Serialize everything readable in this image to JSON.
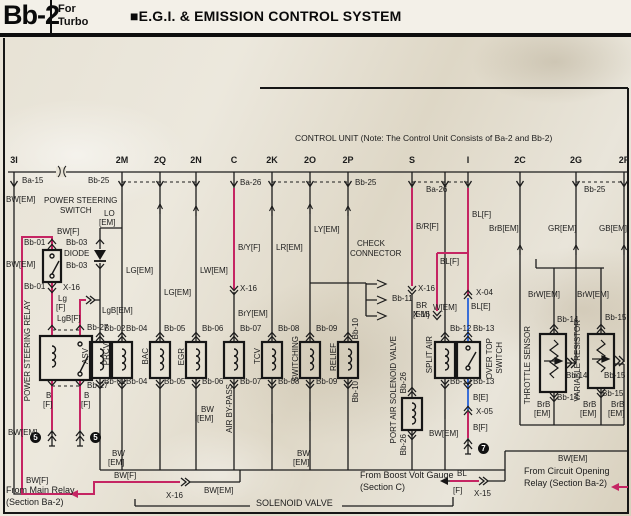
{
  "header": {
    "page_code": "Bb-2",
    "variant_line1": "For",
    "variant_line2": "Turbo",
    "title": "■E.G.I. & EMISSION CONTROL SYSTEM"
  },
  "control_unit_note": "CONTROL UNIT (Note: The Control Unit Consists of Ba-2 and Bb-2)",
  "accent_colors": {
    "highlight_wire": "#c52563",
    "blue_wire": "#3a6fd8",
    "ink": "#1a1a1a"
  },
  "diagram": {
    "labels": [
      {
        "n": "pin-3i",
        "t": "3I",
        "x": 14,
        "y": 156,
        "k": "pin"
      },
      {
        "n": "pin-2m",
        "t": "2M",
        "x": 122,
        "y": 156,
        "k": "pin"
      },
      {
        "n": "pin-2q",
        "t": "2Q",
        "x": 160,
        "y": 156,
        "k": "pin"
      },
      {
        "n": "pin-2n",
        "t": "2N",
        "x": 196,
        "y": 156,
        "k": "pin"
      },
      {
        "n": "pin-c",
        "t": "C",
        "x": 234,
        "y": 156,
        "k": "pin"
      },
      {
        "n": "pin-2k",
        "t": "2K",
        "x": 272,
        "y": 156,
        "k": "pin"
      },
      {
        "n": "pin-2o",
        "t": "2O",
        "x": 310,
        "y": 156,
        "k": "pin"
      },
      {
        "n": "pin-2p",
        "t": "2P",
        "x": 348,
        "y": 156,
        "k": "pin"
      },
      {
        "n": "pin-s",
        "t": "S",
        "x": 412,
        "y": 156,
        "k": "pin"
      },
      {
        "n": "pin-i",
        "t": "I",
        "x": 468,
        "y": 156,
        "k": "pin"
      },
      {
        "n": "pin-2c",
        "t": "2C",
        "x": 520,
        "y": 156,
        "k": "pin"
      },
      {
        "n": "pin-2g",
        "t": "2G",
        "x": 576,
        "y": 156,
        "k": "pin"
      },
      {
        "n": "pin-2f",
        "t": "2F",
        "x": 624,
        "y": 156,
        "k": "pin"
      },
      {
        "n": "conn-ba15",
        "t": "Ba-15",
        "x": 22,
        "y": 177,
        "k": "ref"
      },
      {
        "n": "conn-bb25-a",
        "t": "Bb-25",
        "x": 88,
        "y": 177,
        "k": "ref"
      },
      {
        "n": "conn-ba26-a",
        "t": "Ba-26",
        "x": 240,
        "y": 179,
        "k": "ref"
      },
      {
        "n": "conn-bb25-b",
        "t": "Bb-25",
        "x": 355,
        "y": 179,
        "k": "ref"
      },
      {
        "n": "conn-ba26-b",
        "t": "Ba-26",
        "x": 426,
        "y": 186,
        "k": "ref"
      },
      {
        "n": "conn-bb25-c",
        "t": "Bb-25",
        "x": 584,
        "y": 186,
        "k": "ref"
      },
      {
        "n": "wire-bw-em-top",
        "t": "BW[EM]",
        "x": 6,
        "y": 196,
        "k": "wire"
      },
      {
        "n": "label-power-steering",
        "t": "POWER STEERING",
        "x": 44,
        "y": 197,
        "k": "name"
      },
      {
        "n": "label-switch",
        "t": "SWITCH",
        "x": 60,
        "y": 207,
        "k": "name"
      },
      {
        "n": "wire-bw-f-top",
        "t": "BW[F]",
        "x": 57,
        "y": 228,
        "k": "wire"
      },
      {
        "n": "conn-bb01-top",
        "t": "Bb-01",
        "x": 24,
        "y": 239,
        "k": "ref"
      },
      {
        "n": "conn-bb01-bot",
        "t": "Bb-01",
        "x": 24,
        "y": 283,
        "k": "ref"
      },
      {
        "n": "wire-bw-em-switch",
        "t": "BW[EM]",
        "x": 6,
        "y": 261,
        "k": "wire"
      },
      {
        "n": "conn-x16-switch",
        "t": "X-16",
        "x": 63,
        "y": 284,
        "k": "ref"
      },
      {
        "n": "wire-lg-f-1",
        "t": "Lg",
        "x": 58,
        "y": 295,
        "k": "wire"
      },
      {
        "n": "wire-lg-f-2",
        "t": "[F]",
        "x": 56,
        "y": 304,
        "k": "wire"
      },
      {
        "n": "wire-lgb-f",
        "t": "LgB[F]",
        "x": 57,
        "y": 315,
        "k": "wire"
      },
      {
        "n": "conn-bb03-top",
        "t": "Bb-03",
        "x": 66,
        "y": 239,
        "k": "ref"
      },
      {
        "n": "label-diode",
        "t": "DIODE",
        "x": 64,
        "y": 250,
        "k": "name"
      },
      {
        "n": "conn-bb03-bot",
        "t": "Bb-03",
        "x": 66,
        "y": 262,
        "k": "ref"
      },
      {
        "n": "wire-lo-1",
        "t": "LO",
        "x": 104,
        "y": 210,
        "k": "wire"
      },
      {
        "n": "wire-lo-2",
        "t": "[EM]",
        "x": 99,
        "y": 219,
        "k": "wire"
      },
      {
        "n": "wire-lgb-em",
        "t": "LgB[EM]",
        "x": 102,
        "y": 307,
        "k": "wire"
      },
      {
        "n": "name-ps-relay",
        "t": "POWER STEERING RELAY",
        "x": 24,
        "y": 300,
        "k": "vname"
      },
      {
        "n": "conn-bb27-top",
        "t": "Bb-27",
        "x": 87,
        "y": 324,
        "k": "ref"
      },
      {
        "n": "conn-bb27-bot",
        "t": "Bb-27",
        "x": 87,
        "y": 382,
        "k": "ref"
      },
      {
        "n": "wire-b-f-l1",
        "t": "B",
        "x": 46,
        "y": 392,
        "k": "wire"
      },
      {
        "n": "wire-b-f-l2",
        "t": "[F]",
        "x": 43,
        "y": 401,
        "k": "wire"
      },
      {
        "n": "wire-b-f-r1",
        "t": "B",
        "x": 84,
        "y": 392,
        "k": "wire"
      },
      {
        "n": "wire-b-f-r2",
        "t": "[F]",
        "x": 81,
        "y": 401,
        "k": "wire"
      },
      {
        "n": "badge-ground-5a",
        "t": "5",
        "x": 30,
        "y": 432,
        "k": "badge"
      },
      {
        "n": "badge-ground-5b",
        "t": "5",
        "x": 90,
        "y": 432,
        "k": "badge"
      },
      {
        "n": "wire-bw-em-left-bot",
        "t": "BW[EM]",
        "x": 8,
        "y": 429,
        "k": "wire"
      },
      {
        "n": "conn-bb02-top",
        "t": "Bb-02",
        "x": 104,
        "y": 325,
        "k": "ref"
      },
      {
        "n": "conn-bb02-bot",
        "t": "Bb-02",
        "x": 104,
        "y": 378,
        "k": "ref"
      },
      {
        "n": "name-asv",
        "t": "ASV",
        "x": 82,
        "y": 348,
        "k": "vname"
      },
      {
        "n": "wire-lg-em-2m",
        "t": "LG[EM]",
        "x": 126,
        "y": 267,
        "k": "wire"
      },
      {
        "n": "conn-bb04-top",
        "t": "Bb-04",
        "x": 126,
        "y": 325,
        "k": "ref"
      },
      {
        "n": "conn-bb04-bot",
        "t": "Bb-04",
        "x": 126,
        "y": 378,
        "k": "ref"
      },
      {
        "n": "name-prcv",
        "t": "PRCV",
        "x": 103,
        "y": 343,
        "k": "vname"
      },
      {
        "n": "wire-lg-em-2q",
        "t": "LG[EM]",
        "x": 164,
        "y": 289,
        "k": "wire"
      },
      {
        "n": "conn-bb05-top",
        "t": "Bb-05",
        "x": 164,
        "y": 325,
        "k": "ref"
      },
      {
        "n": "conn-bb05-bot",
        "t": "Bb-05",
        "x": 164,
        "y": 378,
        "k": "ref"
      },
      {
        "n": "name-bac",
        "t": "BAC",
        "x": 142,
        "y": 348,
        "k": "vname"
      },
      {
        "n": "wire-lw-em",
        "t": "LW[EM]",
        "x": 200,
        "y": 267,
        "k": "wire"
      },
      {
        "n": "conn-bb06-top",
        "t": "Bb-06",
        "x": 202,
        "y": 325,
        "k": "ref"
      },
      {
        "n": "conn-bb06-bot",
        "t": "Bb-06",
        "x": 202,
        "y": 378,
        "k": "ref"
      },
      {
        "n": "name-egr",
        "t": "EGR",
        "x": 178,
        "y": 348,
        "k": "vname"
      },
      {
        "n": "wire-by-f",
        "t": "B/Y[F]",
        "x": 238,
        "y": 244,
        "k": "wire"
      },
      {
        "n": "conn-x16-c",
        "t": "X-16",
        "x": 240,
        "y": 285,
        "k": "ref"
      },
      {
        "n": "wire-bry-em",
        "t": "BrY[EM]",
        "x": 238,
        "y": 310,
        "k": "wire"
      },
      {
        "n": "conn-bb07-top",
        "t": "Bb-07",
        "x": 240,
        "y": 325,
        "k": "ref"
      },
      {
        "n": "conn-bb07-bot",
        "t": "Bb-07",
        "x": 240,
        "y": 378,
        "k": "ref"
      },
      {
        "n": "name-air-by-pass",
        "t": "AIR BY-PASS",
        "x": 226,
        "y": 384,
        "k": "vname"
      },
      {
        "n": "wire-lr-em",
        "t": "LR[EM]",
        "x": 276,
        "y": 244,
        "k": "wire"
      },
      {
        "n": "conn-bb08-top",
        "t": "Bb-08",
        "x": 278,
        "y": 325,
        "k": "ref"
      },
      {
        "n": "conn-bb08-bot",
        "t": "Bb-08",
        "x": 278,
        "y": 378,
        "k": "ref"
      },
      {
        "n": "name-tcv",
        "t": "TCV",
        "x": 254,
        "y": 348,
        "k": "vname"
      },
      {
        "n": "wire-ly-em",
        "t": "LY[EM]",
        "x": 314,
        "y": 226,
        "k": "wire"
      },
      {
        "n": "conn-bb09-top",
        "t": "Bb-09",
        "x": 316,
        "y": 325,
        "k": "ref"
      },
      {
        "n": "conn-bb09-bot",
        "t": "Bb-09",
        "x": 316,
        "y": 378,
        "k": "ref"
      },
      {
        "n": "name-switching",
        "t": "SWITCHING",
        "x": 292,
        "y": 336,
        "k": "vname"
      },
      {
        "n": "label-check",
        "t": "CHECK",
        "x": 357,
        "y": 240,
        "k": "name"
      },
      {
        "n": "label-connector",
        "t": "CONNECTOR",
        "x": 350,
        "y": 250,
        "k": "name"
      },
      {
        "n": "conn-bb11",
        "t": "Bb-11",
        "x": 392,
        "y": 295,
        "k": "ref"
      },
      {
        "n": "conn-bb10-top",
        "t": "Bb-10",
        "x": 352,
        "y": 318,
        "k": "vref"
      },
      {
        "n": "conn-bb10-bot",
        "t": "Bb-10",
        "x": 352,
        "y": 381,
        "k": "vref"
      },
      {
        "n": "name-relief",
        "t": "RELIEF",
        "x": 330,
        "y": 343,
        "k": "vname"
      },
      {
        "n": "wire-br-f",
        "t": "B/R[F]",
        "x": 416,
        "y": 223,
        "k": "wire"
      },
      {
        "n": "conn-x16-s",
        "t": "X-16",
        "x": 418,
        "y": 285,
        "k": "ref"
      },
      {
        "n": "wire-br-em-1",
        "t": "BR",
        "x": 416,
        "y": 302,
        "k": "wire"
      },
      {
        "n": "wire-br-em-2",
        "t": "[EM]",
        "x": 413,
        "y": 311,
        "k": "wire"
      },
      {
        "n": "name-port-air",
        "t": "PORT AIR SOLENOID VALVE",
        "x": 390,
        "y": 336,
        "k": "vname"
      },
      {
        "n": "conn-bb26-top",
        "t": "Bb-26",
        "x": 400,
        "y": 372,
        "k": "vref"
      },
      {
        "n": "conn-bb26-bot",
        "t": "Bb-26",
        "x": 400,
        "y": 434,
        "k": "vref"
      },
      {
        "n": "wire-w-em",
        "t": "W[EM]",
        "x": 433,
        "y": 304,
        "k": "wire"
      },
      {
        "n": "conn-bb12-top",
        "t": "Bb-12",
        "x": 450,
        "y": 325,
        "k": "ref"
      },
      {
        "n": "conn-bb12-bot",
        "t": "Bb-12",
        "x": 450,
        "y": 378,
        "k": "ref"
      },
      {
        "n": "name-split-air",
        "t": "SPLIT AIR",
        "x": 426,
        "y": 336,
        "k": "vname"
      },
      {
        "n": "wire-bw-em-split",
        "t": "BW[EM]",
        "x": 429,
        "y": 430,
        "k": "wire"
      },
      {
        "n": "wire-bl-f-main",
        "t": "BL[F]",
        "x": 472,
        "y": 211,
        "k": "wire"
      },
      {
        "n": "wire-bl-f-branch",
        "t": "BL[F]",
        "x": 440,
        "y": 258,
        "k": "wire"
      },
      {
        "n": "conn-x16-branch",
        "t": "X-16",
        "x": 413,
        "y": 311,
        "k": "ref"
      },
      {
        "n": "conn-x04",
        "t": "X-04",
        "x": 476,
        "y": 289,
        "k": "ref"
      },
      {
        "n": "wire-bl-e",
        "t": "BL[E]",
        "x": 471,
        "y": 303,
        "k": "wire"
      },
      {
        "n": "conn-bb13-top",
        "t": "Bb-13",
        "x": 473,
        "y": 325,
        "k": "ref"
      },
      {
        "n": "conn-bb13-bot",
        "t": "Bb-13",
        "x": 473,
        "y": 378,
        "k": "ref"
      },
      {
        "n": "name-over-top",
        "t": "OVER TOP",
        "x": 486,
        "y": 338,
        "k": "vname"
      },
      {
        "n": "name-over-top-switch",
        "t": "SWITCH",
        "x": 496,
        "y": 342,
        "k": "vname"
      },
      {
        "n": "wire-b-e",
        "t": "B[E]",
        "x": 473,
        "y": 394,
        "k": "wire"
      },
      {
        "n": "conn-x05",
        "t": "X-05",
        "x": 476,
        "y": 408,
        "k": "ref"
      },
      {
        "n": "wire-b-f-overtop",
        "t": "B[F]",
        "x": 473,
        "y": 424,
        "k": "wire"
      },
      {
        "n": "badge-ground-7",
        "t": "7",
        "x": 478,
        "y": 443,
        "k": "badge"
      },
      {
        "n": "wire-brb-em-2c",
        "t": "BrB[EM]",
        "x": 489,
        "y": 225,
        "k": "wire"
      },
      {
        "n": "wire-gr-em",
        "t": "GR[EM]",
        "x": 548,
        "y": 225,
        "k": "wire"
      },
      {
        "n": "wire-gb-em",
        "t": "GB[EM]",
        "x": 599,
        "y": 225,
        "k": "wire"
      },
      {
        "n": "wire-brw-em-1",
        "t": "BrW[EM]",
        "x": 528,
        "y": 291,
        "k": "wire"
      },
      {
        "n": "wire-brw-em-2",
        "t": "BrW[EM]",
        "x": 577,
        "y": 291,
        "k": "wire"
      },
      {
        "n": "name-throttle-sensor",
        "t": "THROTTLE SENSOR",
        "x": 524,
        "y": 326,
        "k": "vname"
      },
      {
        "n": "conn-bb14-top",
        "t": "Bb-14",
        "x": 557,
        "y": 316,
        "k": "ref"
      },
      {
        "n": "conn-bb14-wiper",
        "t": "Bb-14",
        "x": 566,
        "y": 372,
        "k": "ref"
      },
      {
        "n": "conn-bb14-bot",
        "t": "Bb-14",
        "x": 557,
        "y": 394,
        "k": "ref"
      },
      {
        "n": "name-variable-resistor",
        "t": "VARIABLE RESISTOR",
        "x": 574,
        "y": 320,
        "k": "vname"
      },
      {
        "n": "conn-bb15-top",
        "t": "Bb-15",
        "x": 605,
        "y": 314,
        "k": "ref"
      },
      {
        "n": "conn-bb15-wiper",
        "t": "Bb-15",
        "x": 604,
        "y": 372,
        "k": "ref"
      },
      {
        "n": "conn-bb15-bot",
        "t": "Bb-15",
        "x": 602,
        "y": 390,
        "k": "ref"
      },
      {
        "n": "wire-brb-1a",
        "t": "BrB",
        "x": 537,
        "y": 401,
        "k": "wire"
      },
      {
        "n": "wire-brb-1b",
        "t": "[EM]",
        "x": 534,
        "y": 410,
        "k": "wire"
      },
      {
        "n": "wire-brb-2a",
        "t": "BrB",
        "x": 583,
        "y": 401,
        "k": "wire"
      },
      {
        "n": "wire-brb-2b",
        "t": "[EM]",
        "x": 580,
        "y": 410,
        "k": "wire"
      },
      {
        "n": "wire-brb-3a",
        "t": "BrB",
        "x": 611,
        "y": 401,
        "k": "wire"
      },
      {
        "n": "wire-brb-3b",
        "t": "[EM]",
        "x": 608,
        "y": 410,
        "k": "wire"
      },
      {
        "n": "wire-bw-em-bus1a",
        "t": "BW",
        "x": 112,
        "y": 450,
        "k": "wire"
      },
      {
        "n": "wire-bw-em-bus1b",
        "t": "[EM]",
        "x": 108,
        "y": 459,
        "k": "wire"
      },
      {
        "n": "wire-bw-em-bus2a",
        "t": "BW",
        "x": 201,
        "y": 406,
        "k": "wire"
      },
      {
        "n": "wire-bw-em-bus2b",
        "t": "[EM]",
        "x": 197,
        "y": 415,
        "k": "wire"
      },
      {
        "n": "wire-bw-em-bus3a",
        "t": "BW",
        "x": 297,
        "y": 450,
        "k": "wire"
      },
      {
        "n": "wire-bw-em-bus3b",
        "t": "[EM]",
        "x": 293,
        "y": 459,
        "k": "wire"
      },
      {
        "n": "wire-bw-em-right-bus",
        "t": "BW[EM]",
        "x": 558,
        "y": 455,
        "k": "wire"
      },
      {
        "n": "wire-bw-f-bot1",
        "t": "BW[F]",
        "x": 26,
        "y": 477,
        "k": "wire"
      },
      {
        "n": "wire-bw-f-bot2",
        "t": "BW[F]",
        "x": 114,
        "y": 472,
        "k": "wire"
      },
      {
        "n": "conn-x16-bottom",
        "t": "X-16",
        "x": 166,
        "y": 492,
        "k": "ref"
      },
      {
        "n": "wire-bw-em-bottom",
        "t": "BW[EM]",
        "x": 204,
        "y": 487,
        "k": "wire"
      },
      {
        "n": "wire-bl-boost",
        "t": "BL",
        "x": 457,
        "y": 470,
        "k": "wire"
      },
      {
        "n": "wire-bl-boost-f",
        "t": "[F]",
        "x": 453,
        "y": 487,
        "k": "wire"
      },
      {
        "n": "conn-x15",
        "t": "X-15",
        "x": 474,
        "y": 490,
        "k": "ref"
      },
      {
        "n": "note-control-unit",
        "t": "CONTROL UNIT (Note: The Control Unit Consists of Ba-2 and Bb-2)",
        "x": 295,
        "y": 134,
        "k": "note"
      },
      {
        "n": "ann-main-relay-1",
        "t": "From Main Relay",
        "x": 6,
        "y": 486,
        "k": "ann"
      },
      {
        "n": "ann-main-relay-2",
        "t": "(Section Ba-2)",
        "x": 6,
        "y": 498,
        "k": "ann"
      },
      {
        "n": "ann-solenoid-valve",
        "t": "SOLENOID VALVE",
        "x": 256,
        "y": 499,
        "k": "ann"
      },
      {
        "n": "ann-boost-1",
        "t": "From Boost Volt Gauge",
        "x": 360,
        "y": 471,
        "k": "ann"
      },
      {
        "n": "ann-boost-2",
        "t": "(Section C)",
        "x": 360,
        "y": 483,
        "k": "ann"
      },
      {
        "n": "ann-circuit-1",
        "t": "From Circuit Opening",
        "x": 524,
        "y": 467,
        "k": "ann"
      },
      {
        "n": "ann-circuit-2",
        "t": "Relay (Section Ba-2)",
        "x": 524,
        "y": 479,
        "k": "ann"
      }
    ]
  }
}
